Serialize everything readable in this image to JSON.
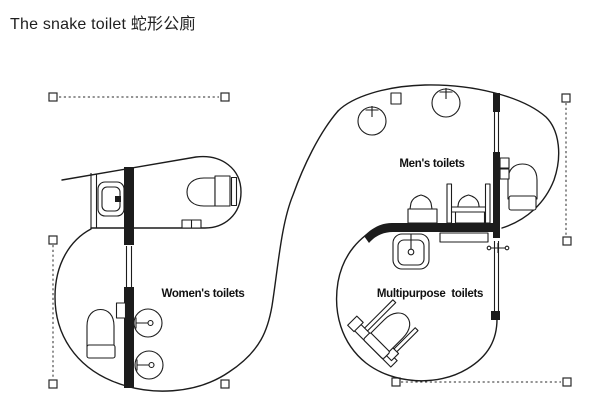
{
  "title": "The snake toilet 蛇形公廁",
  "colors": {
    "ink": "#1c1c1c",
    "background": "#ffffff"
  },
  "rooms": [
    {
      "label": "Men's toilets"
    },
    {
      "label": "Women's toilets"
    },
    {
      "label": "Multipurpose toilets"
    }
  ]
}
